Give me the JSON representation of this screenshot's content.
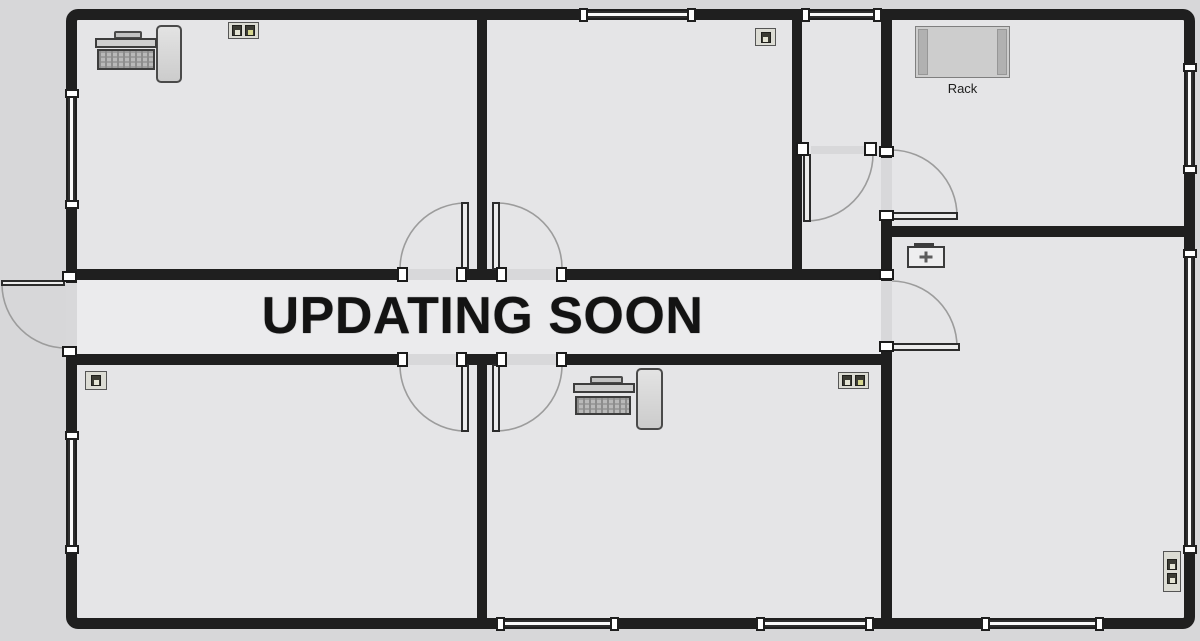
{
  "watermark": "UPDATING SOON",
  "labels": {
    "rack": "Rack"
  },
  "colors": {
    "page_background": "#d7d7d9",
    "floor": "#e5e5e7",
    "corridor_floor": "#ebebed",
    "wall": "#1f1f1f",
    "door_arc": "#9c9c9c",
    "watermark_text": "#131313"
  },
  "equipment": [
    {
      "icon": "computer-workstation-icon",
      "location": "top-left-room"
    },
    {
      "icon": "dual-network-jack-icon",
      "location": "top-left-room"
    },
    {
      "icon": "single-network-jack-icon",
      "location": "top-middle-room"
    },
    {
      "icon": "rack-icon",
      "location": "top-right-room",
      "label": "Rack"
    },
    {
      "icon": "fan-unit-icon",
      "location": "right-room"
    },
    {
      "icon": "single-network-jack-icon",
      "location": "bottom-left-room"
    },
    {
      "icon": "computer-workstation-icon",
      "location": "bottom-middle-room"
    },
    {
      "icon": "dual-network-jack-icon",
      "location": "bottom-middle-room"
    },
    {
      "icon": "dual-network-jack-vertical-icon",
      "location": "bottom-right-room"
    }
  ]
}
